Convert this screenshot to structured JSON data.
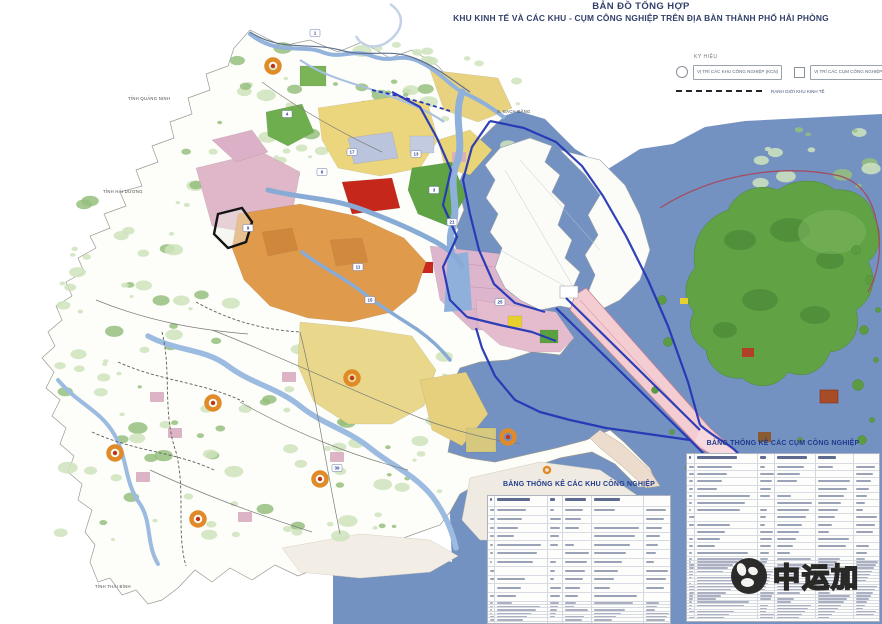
{
  "title": {
    "line1": "BẢN ĐỒ TỔNG HỢP",
    "line2": "KHU KINH TẾ VÀ CÁC KHU - CỤM CÔNG NGHIỆP TRÊN ĐỊA BÀN THÀNH PHỐ HẢI PHÒNG"
  },
  "legend": {
    "title": "KÝ HIỆU",
    "items": [
      {
        "glyph": "circle-icon",
        "label": "VỊ TRÍ CÁC KHU CÔNG NGHIỆP (KCN)"
      },
      {
        "glyph": "square-icon",
        "label": "VỊ TRÍ CÁC CỤM CÔNG NGHIỆP (CCN)"
      },
      {
        "glyph": "dashed-line-icon",
        "label": "RANH GIỚI KHU KINH TẾ"
      }
    ]
  },
  "tables": {
    "left": {
      "title": "BẢNG THỐNG KÊ CÁC KHU CÔNG NGHIỆP"
    },
    "right": {
      "title": "BẢNG THỐNG KÊ CÁC CỤM CÔNG NGHIỆP"
    }
  },
  "map": {
    "region_labels": [
      {
        "text": "TỈNH QUẢNG NINH",
        "x": 128,
        "y": 100
      },
      {
        "text": "TỈNH HẢI DƯƠNG",
        "x": 103,
        "y": 193
      },
      {
        "text": "TỈNH THÁI BÌNH",
        "x": 95,
        "y": 588
      },
      {
        "text": "S. BẠCH ĐẰNG",
        "x": 497,
        "y": 113
      }
    ],
    "markers": [
      {
        "x": 315,
        "y": 33,
        "n": "1"
      },
      {
        "x": 287,
        "y": 114,
        "n": "4"
      },
      {
        "x": 352,
        "y": 152,
        "n": "17"
      },
      {
        "x": 416,
        "y": 154,
        "n": "13"
      },
      {
        "x": 248,
        "y": 228,
        "n": "9"
      },
      {
        "x": 358,
        "y": 267,
        "n": "11"
      },
      {
        "x": 322,
        "y": 172,
        "n": "6"
      },
      {
        "x": 434,
        "y": 190,
        "n": "3"
      },
      {
        "x": 370,
        "y": 300,
        "n": "15"
      },
      {
        "x": 452,
        "y": 222,
        "n": "21"
      },
      {
        "x": 500,
        "y": 302,
        "n": "25"
      },
      {
        "x": 337,
        "y": 468,
        "n": "39"
      }
    ]
  },
  "watermark": {
    "text": "中运加"
  },
  "colors": {
    "sea": "#7392c1",
    "land": "#fdfdf9",
    "cat_ba_green": "#61a245",
    "forest_dark": "#477f31",
    "zone_yellow": "#ecd67d",
    "zone_orange": "#df9a4c",
    "zone_pink": "#e0b6c9",
    "zone_red": "#c6271b",
    "zone_green": "#5fa345",
    "zone_purple": "#bac4dc",
    "river": "#8fb0da",
    "kkt_boundary": "#2437b5",
    "port_strip": "#f4cdd3",
    "flat": "#f0ebe2",
    "ring_orange": "#e08a28",
    "ring_core": "#c03418",
    "table_title": "#1e3a8c",
    "title_navy": "#33406b",
    "marker_navy": "#2a3f8f",
    "label_gray": "#474747",
    "magenta_line": "#a34d62"
  }
}
